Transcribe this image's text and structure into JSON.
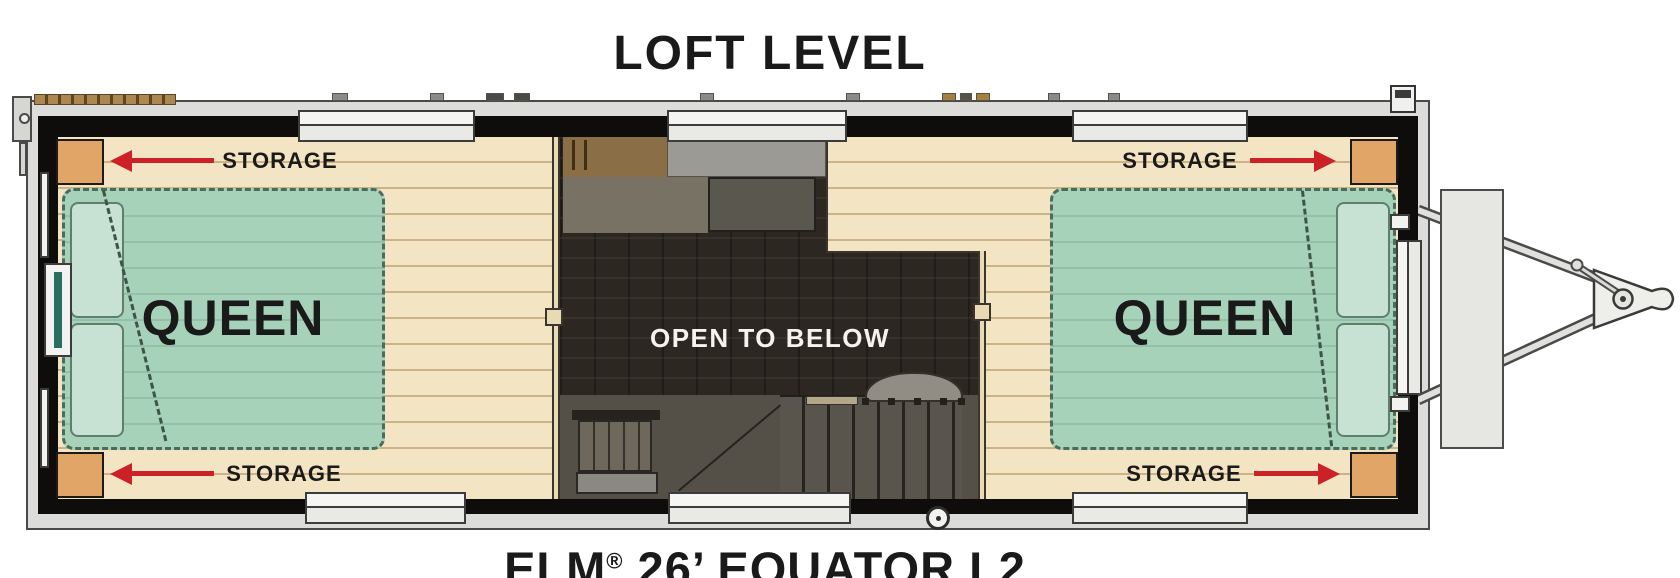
{
  "titles": {
    "plan": "LOFT LEVEL",
    "model_prefix": "ELM",
    "model_reg": "®",
    "model_suffix": " 26’ EQUATOR L2"
  },
  "open_area_label": "OPEN TO BELOW",
  "beds": [
    {
      "label": "QUEEN",
      "side": "left"
    },
    {
      "label": "QUEEN",
      "side": "right"
    }
  ],
  "storage": [
    {
      "label": "STORAGE",
      "corner": "top-left",
      "arrow_direction": "left"
    },
    {
      "label": "STORAGE",
      "corner": "bottom-left",
      "arrow_direction": "left"
    },
    {
      "label": "STORAGE",
      "corner": "top-right",
      "arrow_direction": "right"
    },
    {
      "label": "STORAGE",
      "corner": "bottom-right",
      "arrow_direction": "right"
    }
  ],
  "colors": {
    "arrow_red": "#cc2127",
    "bed_green": "#a6d2ba",
    "pillow_green": "#c7e1d2",
    "wood_floor": "#f3e5c3",
    "wood_rail": "#e9dab4",
    "storage_tan": "#e0a567",
    "wall_black": "#0e0d0b",
    "frame_gray": "#dcdcda",
    "open_dark": "#2d2721",
    "stair_gray": "#544f47",
    "cabinet_brown": "#8a6e46",
    "appliance_gray": "#9c9a94",
    "olive": "#787265",
    "dark_box": "#5a574f",
    "teal": "#2a6e62",
    "text_dark": "#1a1a1a",
    "white_text": "#f5f3ef"
  }
}
